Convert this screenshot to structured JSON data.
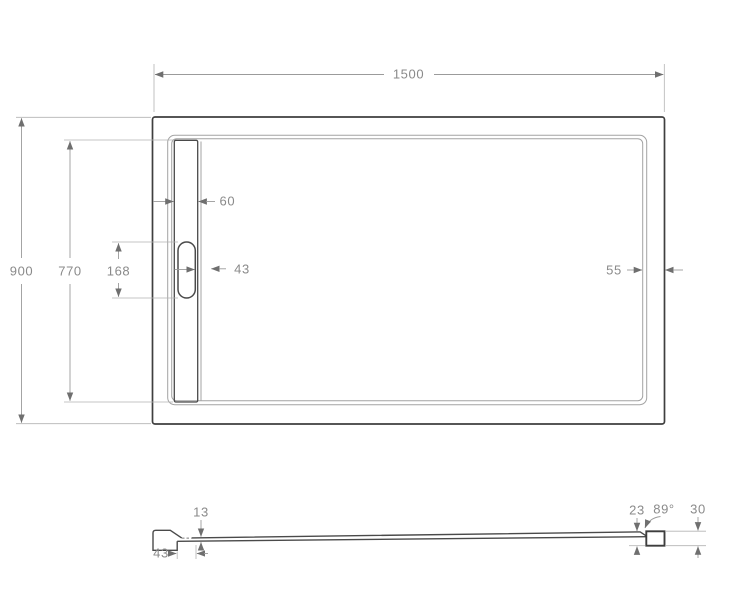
{
  "palette": {
    "outline": "#3f3f3f",
    "rim_outline": "#a3a3a3",
    "dimension_lines": "#9b9b9b",
    "dimension_text": "#8a8a8a",
    "background": "#ffffff"
  },
  "top_view": {
    "dims": {
      "overall_width": "1500",
      "overall_depth": "900",
      "inner_depth": "770",
      "drain_cover_length": "168",
      "drain_channel_width": "60",
      "drain_cover_width": "43",
      "right_rim_width": "55"
    }
  },
  "section_view": {
    "dims": {
      "base_thickness": "13",
      "drain_zone_width": "43",
      "inner_wall_height": "23",
      "wall_angle": "89°",
      "overall_height": "30"
    }
  }
}
